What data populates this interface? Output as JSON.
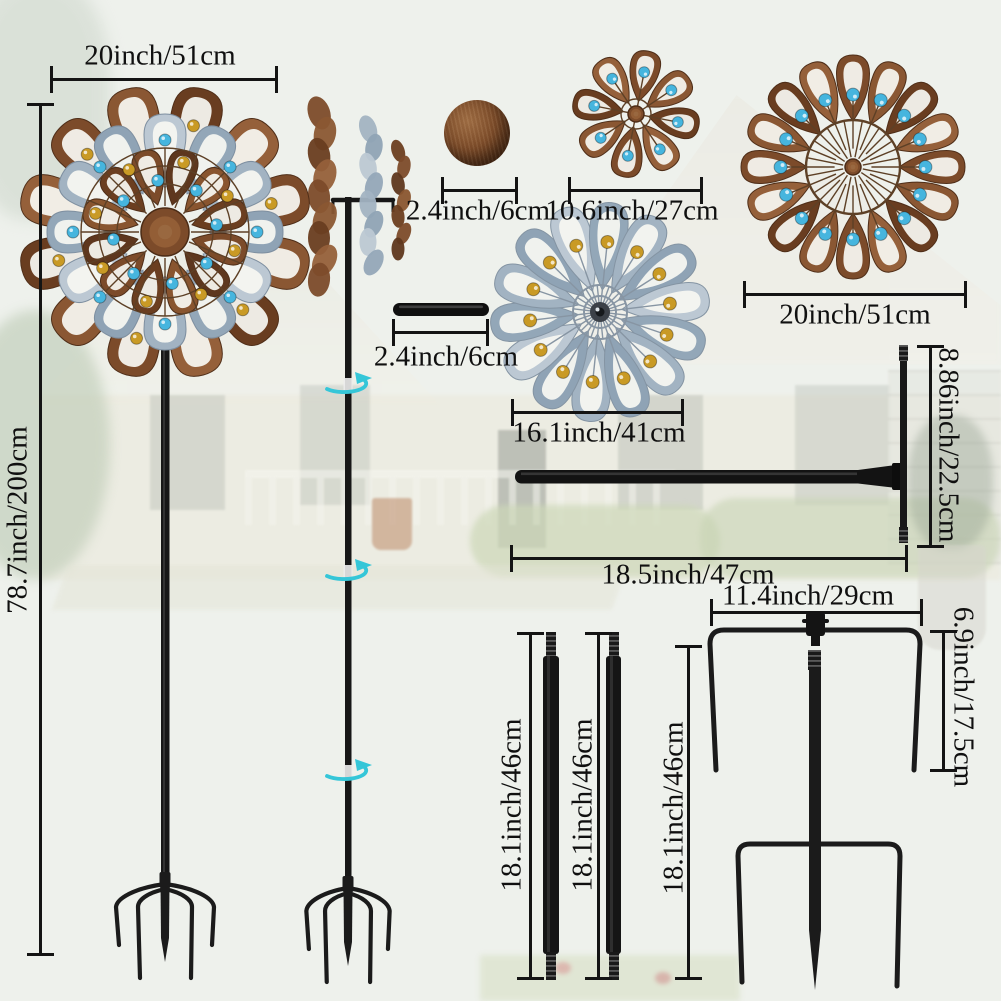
{
  "scene": "Metal wind spinner garden stake dimension diagram over a faded photo of a house front yard with lawn",
  "annotations": {
    "head_width": "20inch/51cm",
    "total_height": "78.7inch/200cm",
    "ball_cap_diameter": "2.4inch/6cm",
    "small_spinner_diameter": "10.6inch/27cm",
    "large_spinner_diameter": "20inch/51cm",
    "connector_tube_length": "2.4inch/6cm",
    "medium_spinner_diameter": "16.1inch/41cm",
    "crossbar_height": "8.86inch/22.5cm",
    "crossbar_length": "18.5inch/47cm",
    "stake_top_width": "11.4inch/29cm",
    "stake_prong_height": "6.9inch/17.5cm",
    "pole_section_a_length": "18.1inch/46cm",
    "pole_section_b_length": "18.1inch/46cm",
    "ground_stake_length": "18.1inch/46cm"
  },
  "icons": [
    "rotation-arrow-icon"
  ],
  "colors": {
    "dimension_ink": "#141414",
    "copper": "#7c4b2a",
    "copper_dark": "#5e371e",
    "copper_light": "#9a6a42",
    "silver_blue": "#a2b3c2",
    "gem_blue": "#46b5de",
    "gem_amber": "#c99a25",
    "rotation_arrow": "#35c6d8",
    "hardware_black": "#171717"
  }
}
